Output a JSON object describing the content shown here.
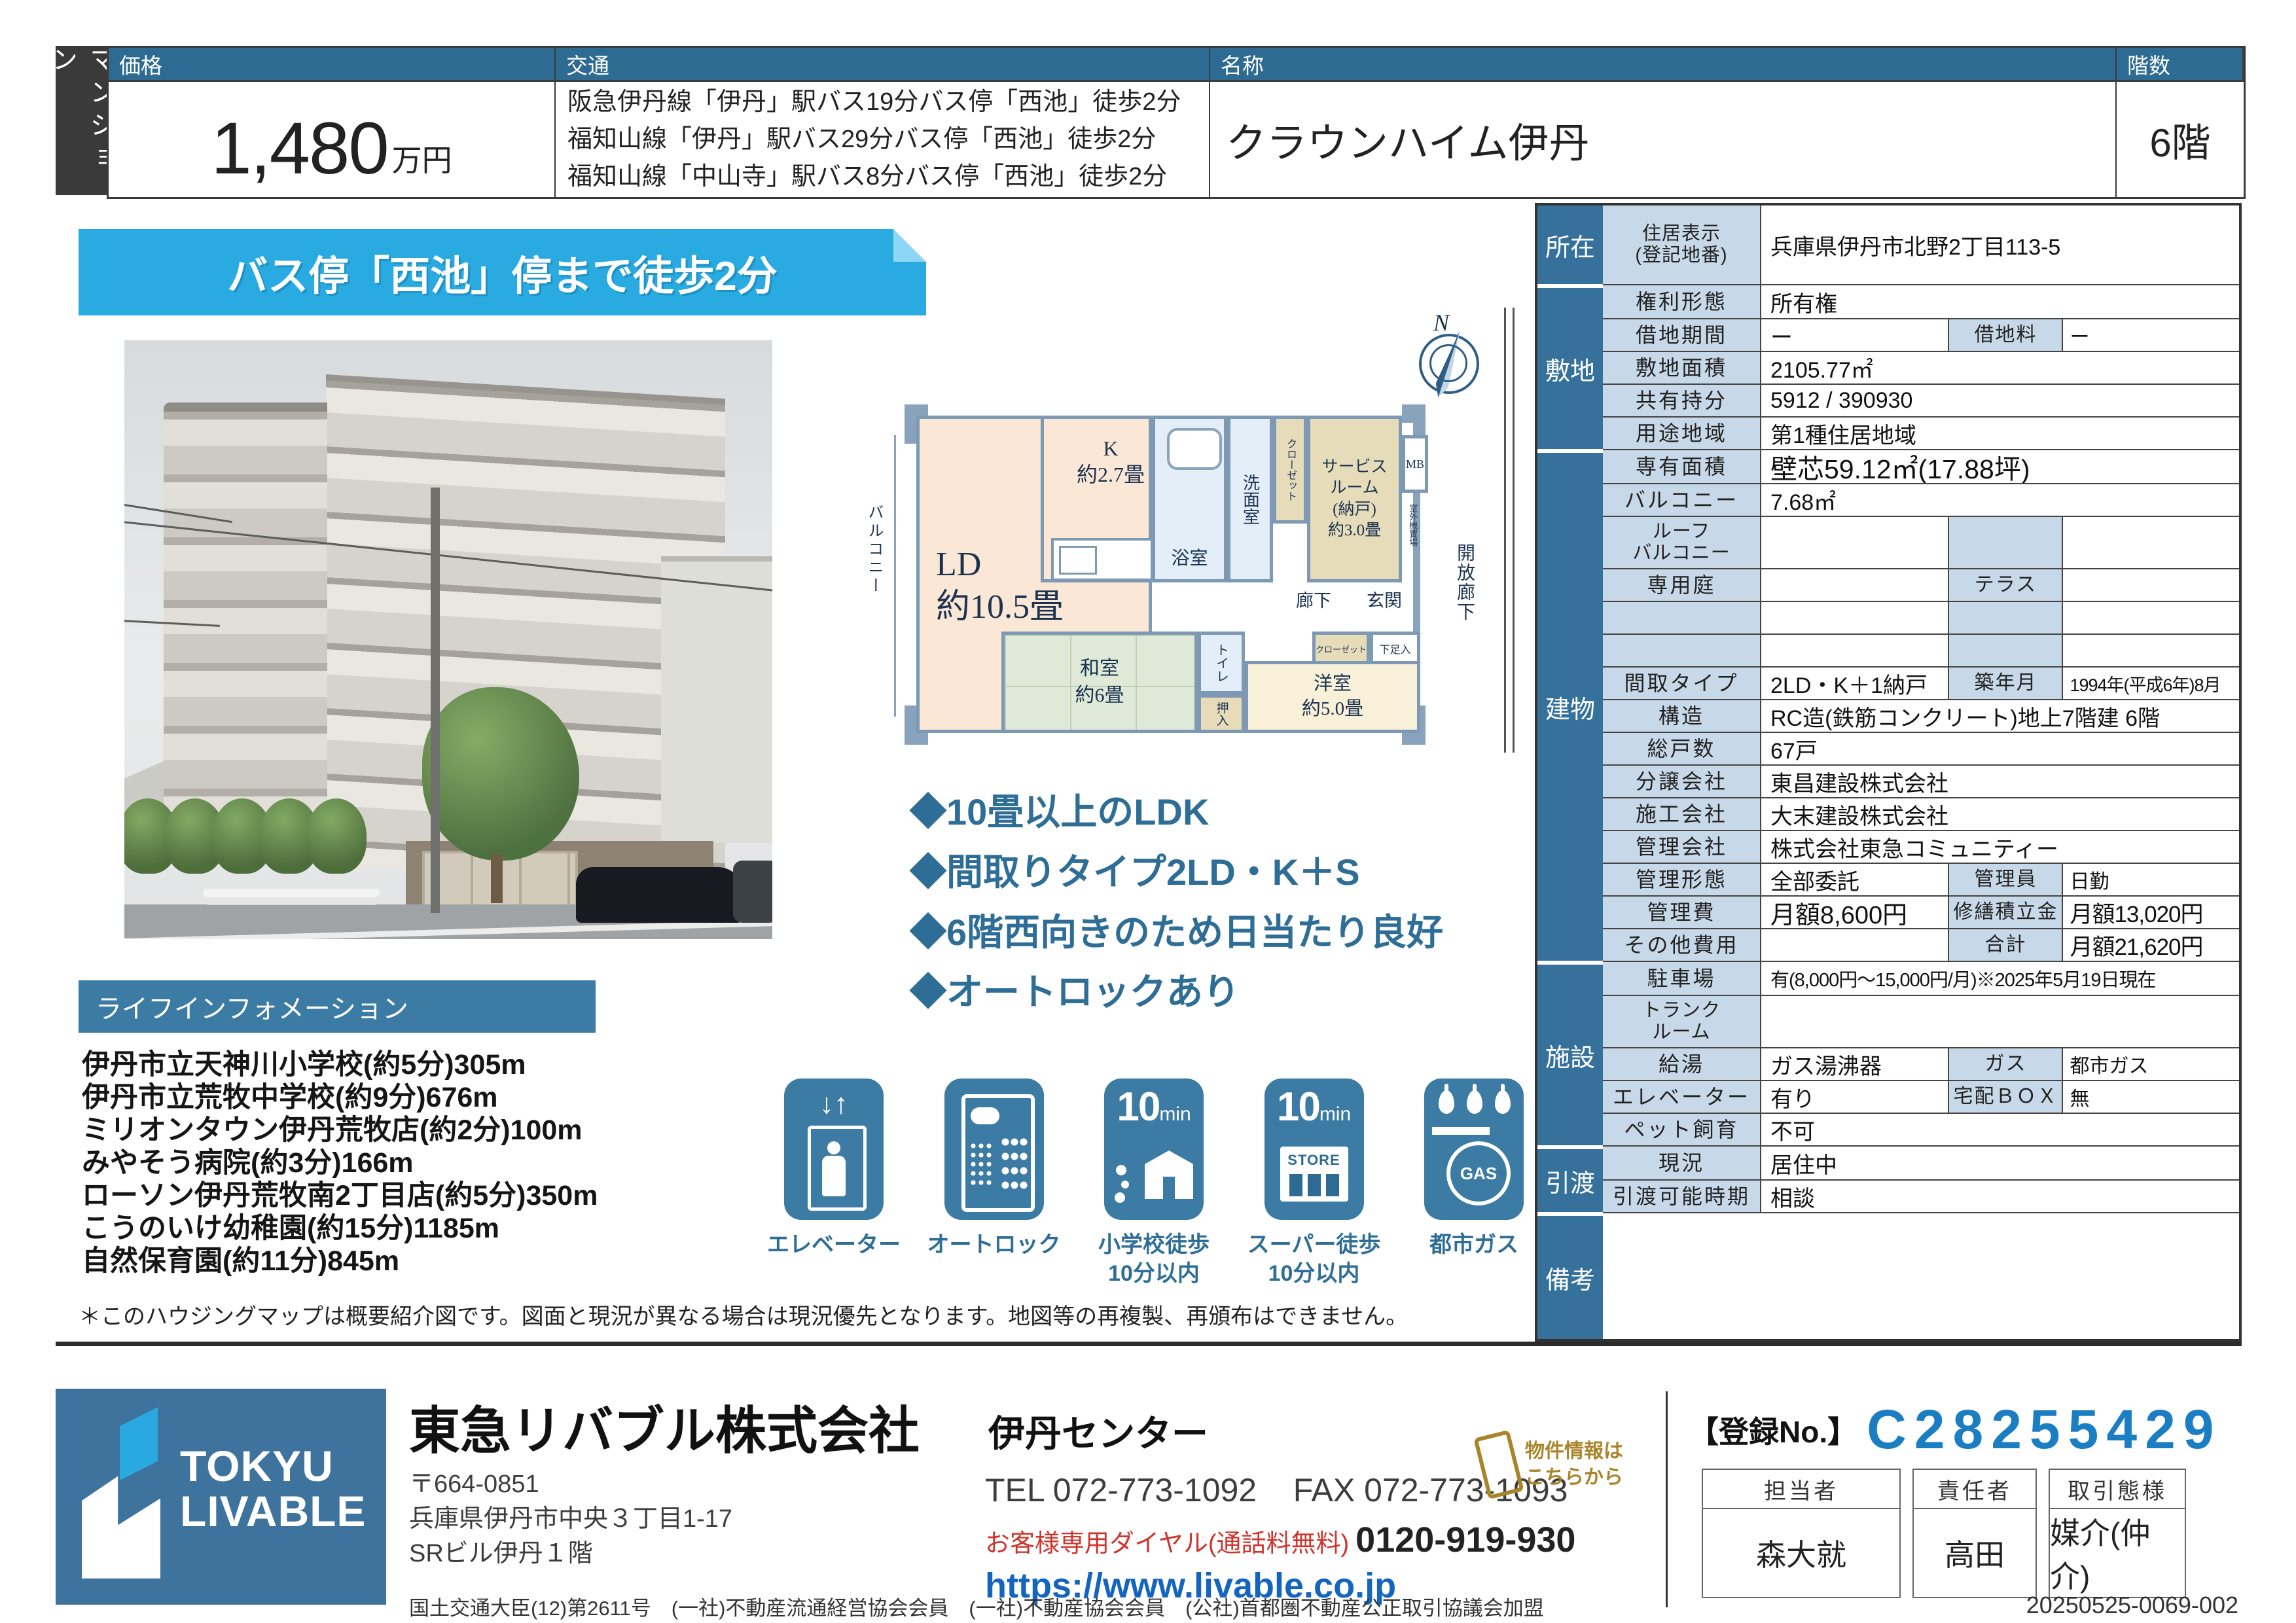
{
  "colors": {
    "steel_blue": "#2d6b92",
    "sidebar_blue": "#35719a",
    "label_cell": "#c7d8e8",
    "banner_cyan": "#29abe2",
    "link_blue": "#1565c0",
    "dial_red": "#d0342c",
    "note_gold": "#a8852a",
    "reg_no_blue": "#1b7ec2"
  },
  "type_tab": "マンション",
  "header": {
    "price_label": "価格",
    "price_value": "1,480",
    "price_unit": "万円",
    "transit_label": "交通",
    "transit_lines": [
      "阪急伊丹線「伊丹」駅バス19分バス停「西池」徒歩2分",
      "福知山線「伊丹」駅バス29分バス停「西池」徒歩2分",
      "福知山線「中山寺」駅バス8分バス停「西池」徒歩2分"
    ],
    "name_label": "名称",
    "name_value": "クラウンハイム伊丹",
    "floor_label": "階数",
    "floor_value": "6階"
  },
  "banner": "バス停「西池」停まで徒歩2分",
  "floorplan": {
    "balcony": "バルコニー",
    "ld": "LD\n約10.5畳",
    "k": "K\n約2.7畳",
    "bath": "浴室",
    "washroom": "洗面室",
    "closet_top": "クローゼット",
    "service_room": "サービス\nルーム\n(納戸)\n約3.0畳",
    "mb": "MB",
    "outdoor_unit": "室外機置場",
    "hallway": "廊下",
    "entrance": "玄関",
    "open_corridor": "開放廊下",
    "toilet": "トイレ",
    "japanese_room": "和室\n約6畳",
    "oshiire": "押入",
    "closet2": "クローゼット",
    "shoe_box": "下足入",
    "western_room": "洋室\n約5.0畳",
    "compass": "N"
  },
  "highlights": [
    "◆10畳以上のLDK",
    "◆間取りタイプ2LD・K＋S",
    "◆6階西向きのため日当たり良好",
    "◆オートロックあり"
  ],
  "life_info": {
    "title": "ライフインフォメーション",
    "items": [
      "伊丹市立天神川小学校(約5分)305m",
      "伊丹市立荒牧中学校(約9分)676m",
      "ミリオンタウン伊丹荒牧店(約2分)100m",
      "みやそう病院(約3分)166m",
      "ローソン伊丹荒牧南2丁目店(約5分)350m",
      "こうのいけ幼稚園(約15分)1185m",
      "自然保育園(約11分)845m"
    ]
  },
  "icons": [
    {
      "caption": "エレベーター"
    },
    {
      "caption": "オートロック"
    },
    {
      "num": "10",
      "unit": "min",
      "caption": "小学校徒歩\n10分以内"
    },
    {
      "num": "10",
      "unit": "min",
      "store": "STORE",
      "caption": "スーパー徒歩\n10分以内"
    },
    {
      "gas": "GAS",
      "caption": "都市ガス"
    }
  ],
  "disclaimer": "＊このハウジングマップは概要紹介図です。図面と現況が異なる場合は現況優先となります。地図等の再複製、再頒布はできません。",
  "property": {
    "sections": [
      {
        "label": "所在",
        "rows": [
          {
            "l": "住居表示\n(登記地番)",
            "v": "兵庫県伊丹市北野2丁目113-5"
          }
        ]
      },
      {
        "label": "敷地",
        "rows": [
          {
            "l": "権利形態",
            "v": "所有権"
          },
          {
            "l": "借地期間",
            "v": "ー",
            "l2": "借地料",
            "v2": "ー"
          },
          {
            "l": "敷地面積",
            "v": "2105.77㎡"
          },
          {
            "l": "共有持分",
            "v": "5912 / 390930"
          },
          {
            "l": "用途地域",
            "v": "第1種住居地域"
          }
        ]
      },
      {
        "label": "建物",
        "rows": [
          {
            "l": "専有面積",
            "v": "壁芯59.12㎡(17.88坪)"
          },
          {
            "l": "バルコニー",
            "v": "7.68㎡"
          },
          {
            "l": "ルーフ\nバルコニー",
            "v": "",
            "l2": "",
            "v2": ""
          },
          {
            "l": "専用庭",
            "v": "",
            "l2": "テラス",
            "v2": ""
          },
          {
            "l": "",
            "v": "",
            "l2": "",
            "v2": ""
          },
          {
            "l": "",
            "v": "",
            "l2": "",
            "v2": ""
          },
          {
            "l": "間取タイプ",
            "v": "2LD・K＋1納戸",
            "l2": "築年月",
            "v2": "1994年(平成6年)8月"
          },
          {
            "l": "構造",
            "v": "RC造(鉄筋コンクリート)地上7階建 6階"
          },
          {
            "l": "総戸数",
            "v": "67戸"
          },
          {
            "l": "分譲会社",
            "v": "東昌建設株式会社"
          },
          {
            "l": "施工会社",
            "v": "大末建設株式会社"
          },
          {
            "l": "管理会社",
            "v": "株式会社東急コミュニティー"
          },
          {
            "l": "管理形態",
            "v": "全部委託",
            "l2": "管理員",
            "v2": "日勤"
          },
          {
            "l": "管理費",
            "v": "月額8,600円",
            "l2": "修繕積立金",
            "v2": "月額13,020円"
          },
          {
            "l": "その他費用",
            "v": "",
            "l2": "合計",
            "v2": "月額21,620円"
          }
        ]
      },
      {
        "label": "施設",
        "rows": [
          {
            "l": "駐車場",
            "v": "有(8,000円～15,000円/月)※2025年5月19日現在"
          },
          {
            "l": "トランク\nルーム",
            "v": ""
          },
          {
            "l": "給湯",
            "v": "ガス湯沸器",
            "l2": "ガス",
            "v2": "都市ガス"
          },
          {
            "l": "エレベーター",
            "v": "有り",
            "l2": "宅配ＢＯＸ",
            "v2": "無"
          },
          {
            "l": "ペット飼育",
            "v": "不可"
          }
        ]
      },
      {
        "label": "引渡",
        "rows": [
          {
            "l": "現況",
            "v": "居住中"
          },
          {
            "l": "引渡可能時期",
            "v": "相談"
          }
        ]
      },
      {
        "label": "備考",
        "rows": [
          {
            "l": "",
            "v": ""
          }
        ]
      }
    ]
  },
  "footer": {
    "logo_line1": "TOKYU",
    "logo_line2": "LIVABLE",
    "company": "東急リバブル株式会社",
    "office": "伊丹センター",
    "postal": "〒664-0851",
    "address1": "兵庫県伊丹市中央３丁目1-17",
    "address2": "SRビル伊丹１階",
    "tel": "TEL 072-773-1092",
    "fax": "FAX 072-773-1093",
    "dial_label": "お客様専用ダイヤル(通話料無料)",
    "dial_number": "0120-919-930",
    "url": "https://www.livable.co.jp",
    "license": "国土交通大臣(12)第2611号　(一社)不動産流通経営協会会員　(一社)不動産協会会員　(公社)首都圏不動産公正取引協議会加盟",
    "reg_label": "【登録No.】",
    "reg_no": "C28255429",
    "qr_note": "物件情報は\nこちらから",
    "staff_headers": [
      "担当者",
      "責任者",
      "取引態様"
    ],
    "staff_values": [
      "森大就",
      "高田",
      "媒介(仲介)"
    ],
    "doc_code": "20250525-0069-002"
  }
}
